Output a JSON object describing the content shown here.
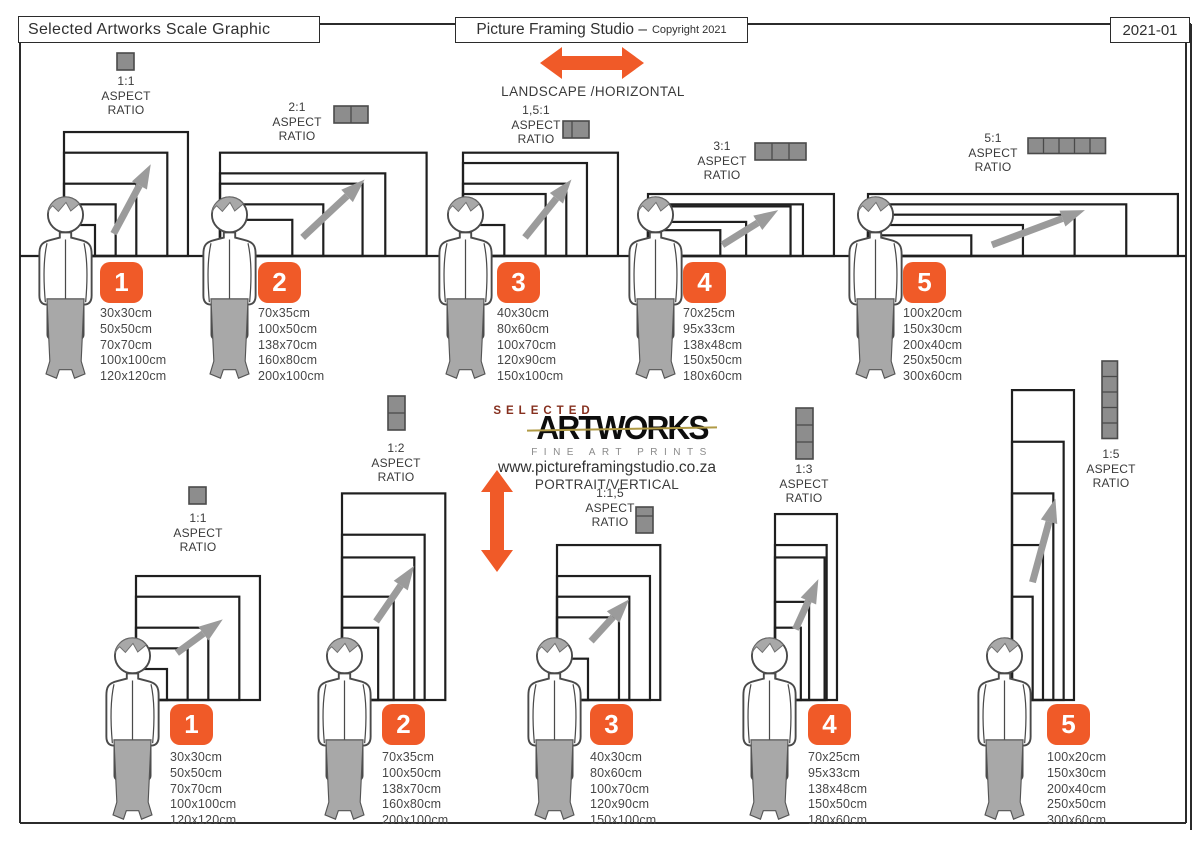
{
  "header": {
    "left_title": "Selected Artworks Scale Graphic",
    "center_title": "Picture Framing Studio –",
    "center_subtitle": "Copyright 2021",
    "right_code": "2021-01"
  },
  "logo": {
    "eyebrow": "SELECTED",
    "name": "ARTWORKS",
    "tagline": "FINE ART PRINTS",
    "website": "www.pictureframingstudio.co.za"
  },
  "labels": {
    "aspect_word": "ASPECT",
    "ratio_word": "RATIO"
  },
  "sections": {
    "landscape": {
      "direction_label": "LANDSCAPE /HORIZONTAL",
      "groups": [
        {
          "number": "1",
          "ratio": "1:1",
          "icon_cells": 1,
          "sizes": [
            "30x30cm",
            "50x50cm",
            "70x70cm",
            "100x100cm",
            "120x120cm"
          ]
        },
        {
          "number": "2",
          "ratio": "2:1",
          "icon_cells": 2,
          "sizes": [
            "70x35cm",
            "100x50cm",
            "138x70cm",
            "160x80cm",
            "200x100cm"
          ]
        },
        {
          "number": "3",
          "ratio": "1,5:1",
          "icon_cells": 1.5,
          "sizes": [
            "40x30cm",
            "80x60cm",
            "100x70cm",
            "120x90cm",
            "150x100cm"
          ]
        },
        {
          "number": "4",
          "ratio": "3:1",
          "icon_cells": 3,
          "sizes": [
            "70x25cm",
            "95x33cm",
            "138x48cm",
            "150x50cm",
            "180x60cm"
          ]
        },
        {
          "number": "5",
          "ratio": "5:1",
          "icon_cells": 5,
          "sizes": [
            "100x20cm",
            "150x30cm",
            "200x40cm",
            "250x50cm",
            "300x60cm"
          ]
        }
      ]
    },
    "portrait": {
      "direction_label": "PORTRAIT/VERTICAL",
      "groups": [
        {
          "number": "1",
          "ratio": "1:1",
          "icon_cells": 1,
          "sizes": [
            "30x30cm",
            "50x50cm",
            "70x70cm",
            "100x100cm",
            "120x120cm"
          ]
        },
        {
          "number": "2",
          "ratio": "1:2",
          "icon_cells": 2,
          "sizes": [
            "70x35cm",
            "100x50cm",
            "138x70cm",
            "160x80cm",
            "200x100cm"
          ]
        },
        {
          "number": "3",
          "ratio": "1:1,5",
          "icon_cells": 1.5,
          "sizes": [
            "40x30cm",
            "80x60cm",
            "100x70cm",
            "120x90cm",
            "150x100cm"
          ]
        },
        {
          "number": "4",
          "ratio": "1:3",
          "icon_cells": 3,
          "sizes": [
            "70x25cm",
            "95x33cm",
            "138x48cm",
            "150x50cm",
            "180x60cm"
          ]
        },
        {
          "number": "5",
          "ratio": "1:5",
          "icon_cells": 5,
          "sizes": [
            "100x20cm",
            "150x30cm",
            "200x40cm",
            "250x50cm",
            "300x60cm"
          ]
        }
      ]
    }
  },
  "colors": {
    "accent_orange": "#F05A28",
    "frame_line": "#1f1f1f",
    "border_line": "#2b2b2b",
    "icon_gray": "#8d8d8d",
    "icon_stroke": "#4a4a4a",
    "person_gray": "#a8a8a8",
    "pointer_gray": "#9b9b9b",
    "logo_maroon": "#86301f",
    "logo_gold": "#b09a45"
  }
}
